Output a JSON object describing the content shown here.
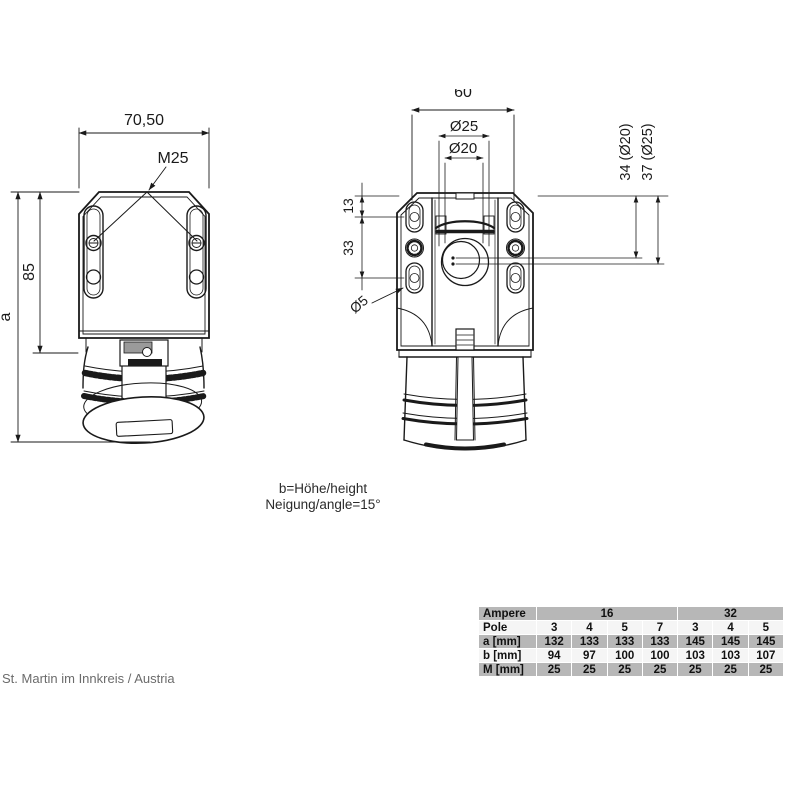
{
  "drawing": {
    "left_view": {
      "dim_width": "70,50",
      "thread_label": "M25",
      "dim_85": "85",
      "dim_a": "a"
    },
    "right_view": {
      "dim_top": "60",
      "dim_d25": "Ø25",
      "dim_d20": "Ø20",
      "dim_13": "13",
      "dim_33": "33",
      "dim_34": "34 (Ø20)",
      "dim_37": "37 (Ø25)",
      "dim_d5": "Ø5"
    },
    "notes": {
      "line1": "b=Höhe/height",
      "line2": "Neigung/angle=15°"
    }
  },
  "footer": {
    "location": "St. Martin im Innkreis / Austria"
  },
  "spec_table": {
    "ampere_label": "Ampere",
    "pole_label": "Pole",
    "groups": [
      {
        "label": "16"
      },
      {
        "label": "32"
      }
    ],
    "pole_values": [
      "3",
      "4",
      "5",
      "7",
      "3",
      "4",
      "5"
    ],
    "rows": [
      {
        "label": "a [mm]",
        "values": [
          "132",
          "133",
          "133",
          "133",
          "145",
          "145",
          "145"
        ]
      },
      {
        "label": "b [mm]",
        "values": [
          "94",
          "97",
          "100",
          "100",
          "103",
          "103",
          "107"
        ]
      },
      {
        "label": "M [mm]",
        "values": [
          "25",
          "25",
          "25",
          "25",
          "25",
          "25",
          "25"
        ]
      }
    ]
  },
  "colors": {
    "line": "#1a1a1a",
    "table_gray": "#b7b7b7",
    "table_light": "#f5f5f5"
  }
}
